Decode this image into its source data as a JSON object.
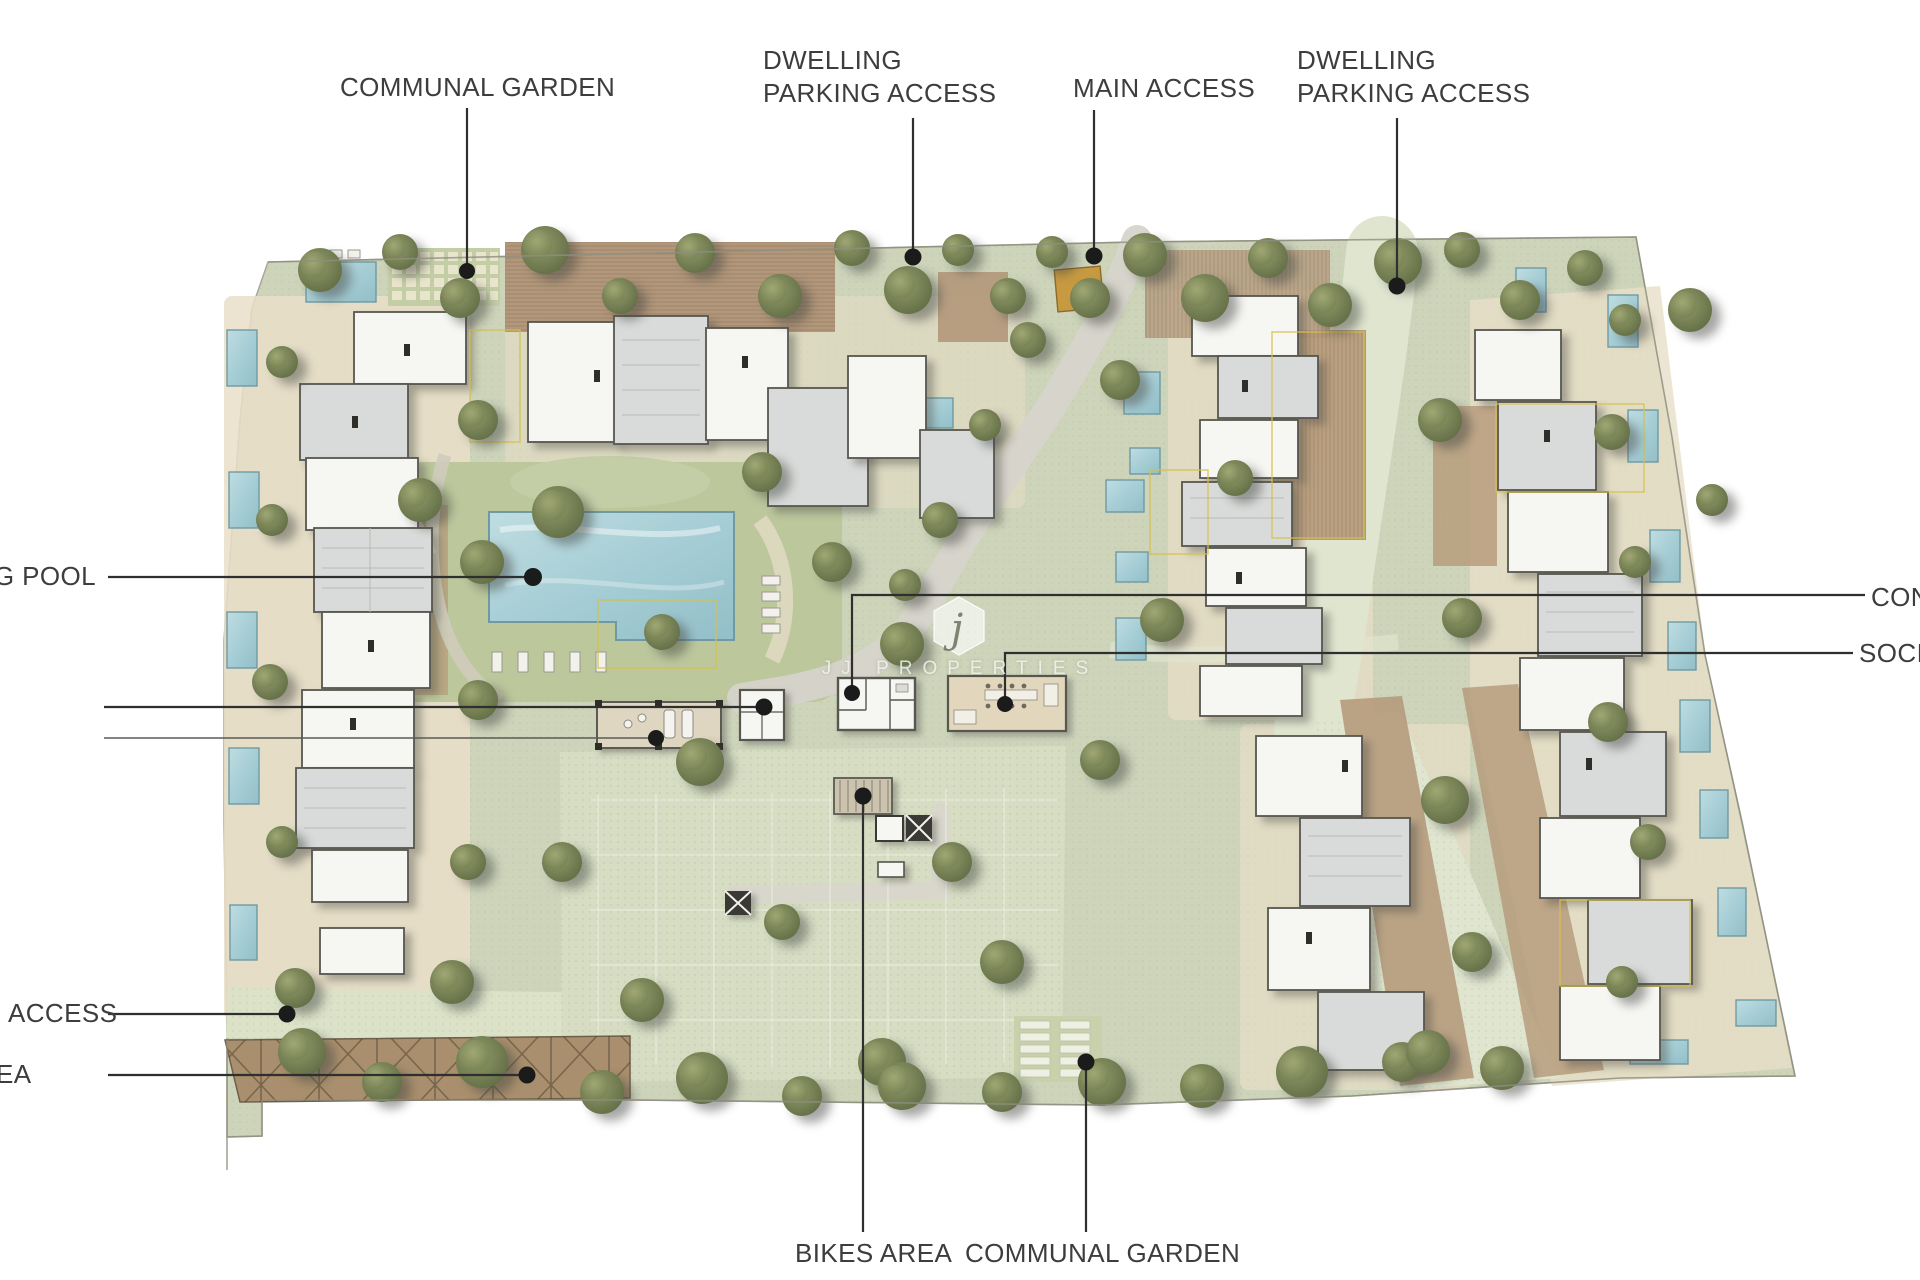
{
  "labels": {
    "top": {
      "communal_garden": "COMMUNAL GARDEN",
      "dwelling_parking_left_line1": "DWELLING",
      "dwelling_parking_left_line2": "PARKING ACCESS",
      "main_access": "MAIN ACCESS",
      "dwelling_parking_right_line1": "DWELLING",
      "dwelling_parking_right_line2": "PARKING ACCESS"
    },
    "left": {
      "swimming_pool_cut": "NG POOL",
      "access_cut": "ACCESS",
      "area_cut": "EA"
    },
    "right": {
      "concierge_cut": "CON",
      "social_cut": "SOCIA"
    },
    "bottom": {
      "bikes_area": "BIKES AREA",
      "communal_garden": "COMMUNAL GARDEN"
    }
  },
  "watermark": {
    "logo_letter": "j",
    "brand": "JJ PROPERTIES"
  },
  "palette": {
    "background": "#ffffff",
    "site_green": "#cdd4ba",
    "path_green": "#dfe5cf",
    "parking_green": "#d6ddc3",
    "lawn_green": "#bcc79c",
    "terrace_beige": "#e9dec8",
    "deck_brown": "#b2977a",
    "pergola_brown": "#a98f6d",
    "road_gray": "#d6d4cb",
    "pool_teal": "#a7ced6",
    "building_white": "#f6f6f3",
    "building_gray": "#d9dbda",
    "outline_gray": "#57564f",
    "access_gate_orange": "#c79a41",
    "tree_olive": "#7b8456",
    "label_text": "#3d3d3d"
  }
}
